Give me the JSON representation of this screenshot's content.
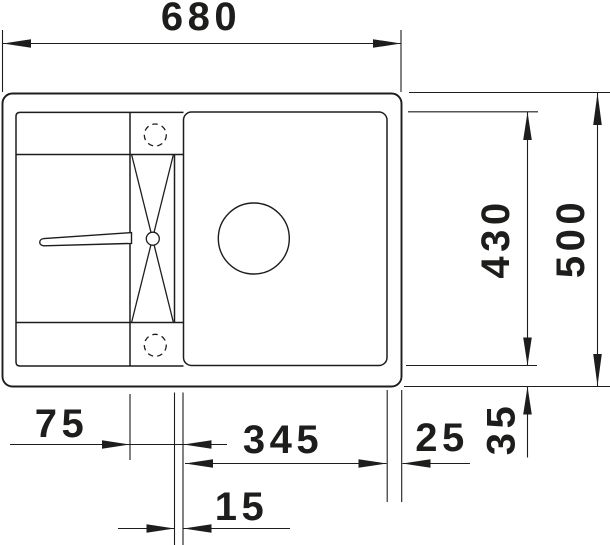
{
  "drawing": {
    "description": "Technical top-view dimension drawing of a kitchen sink with drainboard, tap holes, drain channel and main bowl",
    "background_color": "#ffffff",
    "line_color": "#1d1d1b",
    "labels": {
      "width_overall": "680",
      "depth_overall": "500",
      "depth_bowl": "430",
      "offset_left": "75",
      "width_bowl": "345",
      "gap_right": "25",
      "gap_bottom": "35",
      "gap_channel": "15"
    }
  }
}
